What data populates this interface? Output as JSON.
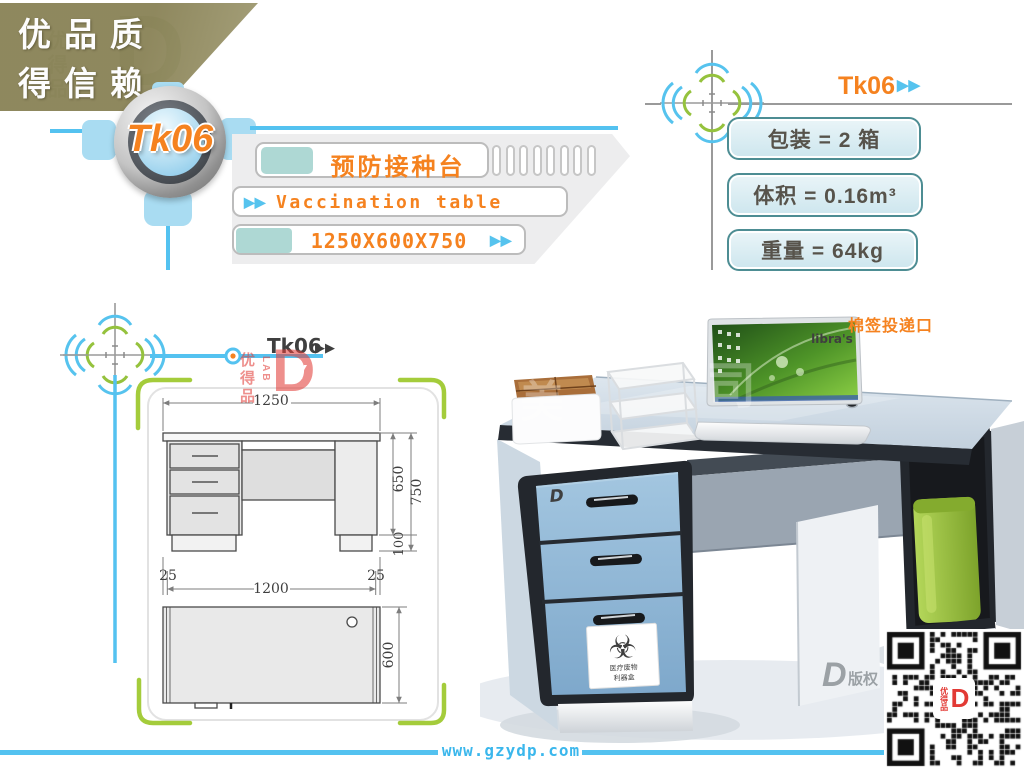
{
  "banner": {
    "slogan_line1": "优品质",
    "slogan_line2": "得信赖"
  },
  "badge": {
    "model": "Tk06"
  },
  "product": {
    "name_cn": "预防接种台",
    "name_en": "Vaccination table",
    "size": "1250X600X750"
  },
  "icons": {
    "double_arrow": "▶▶",
    "biohazard": "☣"
  },
  "specs": {
    "model": "Tk06",
    "rows": [
      {
        "text": "包装 = 2 箱"
      },
      {
        "text": "体积 = 0.16m³"
      },
      {
        "text": "重量 = 64kg"
      }
    ]
  },
  "drawing": {
    "model": "Tk06",
    "dim_width_top": "1250",
    "dim_height_upper": "650",
    "dim_height_total": "750",
    "dim_foot": "100",
    "dim_left_margin": "25",
    "dim_inner_width": "1200",
    "dim_right_margin": "25",
    "dim_depth": "600"
  },
  "photo": {
    "callout": "棉签投递口",
    "laptop_text": "libra's",
    "sticker_line1": "医疗废物",
    "sticker_line2": "利器盒"
  },
  "watermarks": {
    "brand_cn": "优得品",
    "brand_sub": "LAB",
    "brand_letter": "D",
    "brand_y": "Y",
    "copyright": "版权",
    "photo_char1": "美",
    "photo_char2": "司"
  },
  "footer": {
    "website": "www.gzydp.com"
  },
  "colors": {
    "orange": "#f5821f",
    "blue": "#54c2f0",
    "green": "#a6ce39",
    "teal_fill": "#aed8d4",
    "spec_border": "#4d8d93"
  }
}
